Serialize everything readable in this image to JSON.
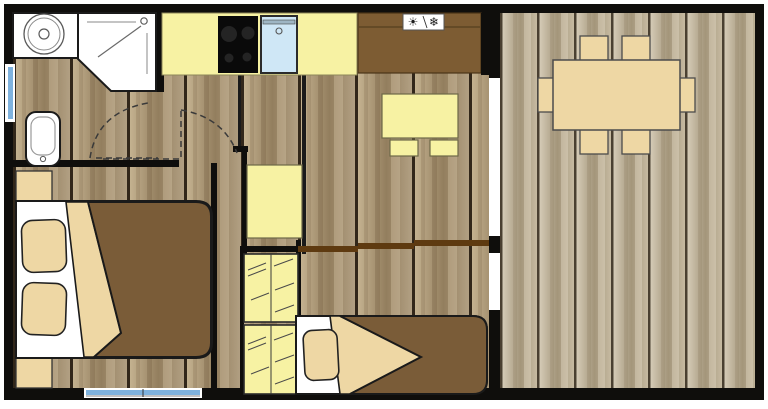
{
  "icons": {
    "sun": "☀",
    "snowflake": "❄"
  },
  "colors": {
    "wall_black": "#0f0e0c",
    "interior_plank_light": "#c9b795",
    "interior_plank_mid": "#b2a083",
    "interior_plank_dark": "#937e5e",
    "interior_seam": "#32271a",
    "terrace_plank_light": "#dcd3bf",
    "terrace_plank_mid": "#c6baa1",
    "terrace_plank_dark": "#a3957a",
    "terrace_seam": "#4a4031",
    "unit_yellow": "#f7f2a3",
    "furniture_tan": "#eed7a4",
    "duvet_brown": "#7a5c38",
    "cabinet_brown": "#7d5c33",
    "rail_brown": "#5e3a10",
    "sink_blue": "#cfe7f6",
    "window_blue": "#7fb2dd",
    "window_frame_gray": "#c2c2c2",
    "fixture_white": "#ffffff",
    "cooktop_black": "#0a0a0a",
    "burner_gray": "#242424"
  }
}
